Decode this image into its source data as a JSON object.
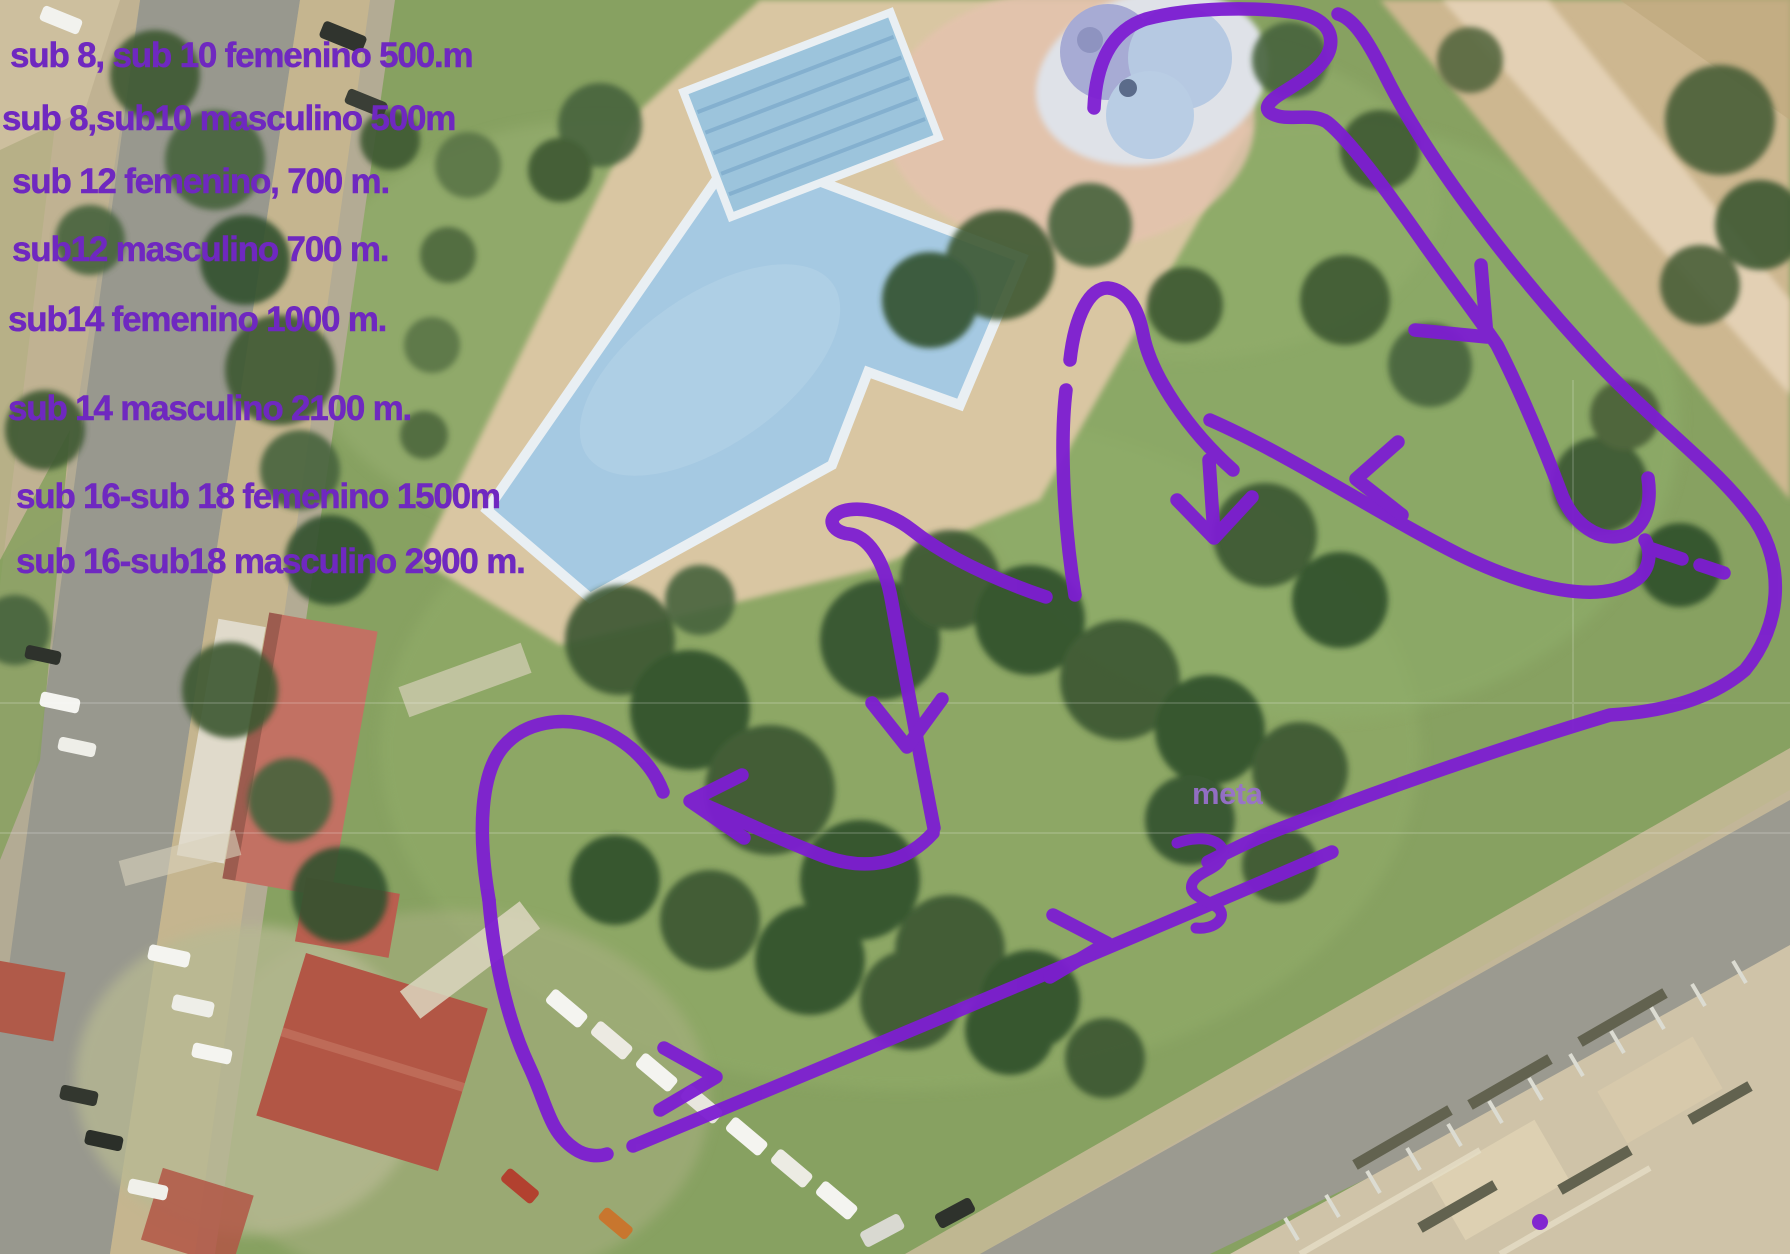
{
  "map": {
    "type": "aerial-cross-country-course-map",
    "course_labels": [
      "sub 8, sub 10 femenino 500.m",
      "sub 8,sub10 masculino 500m",
      "sub 12 femenino, 700 m.",
      "sub12 masculino 700 m.",
      "sub14 femenino 1000 m.",
      "sub 14 masculino 2100 m.",
      "sub 16-sub 18 femenino 1500m",
      "sub 16-sub18 masculino 2900 m."
    ],
    "finish_label": "meta",
    "colors": {
      "route": "#7d1dd2",
      "label_text": "#6f28c0",
      "meta_text": "#9a70cf"
    }
  }
}
